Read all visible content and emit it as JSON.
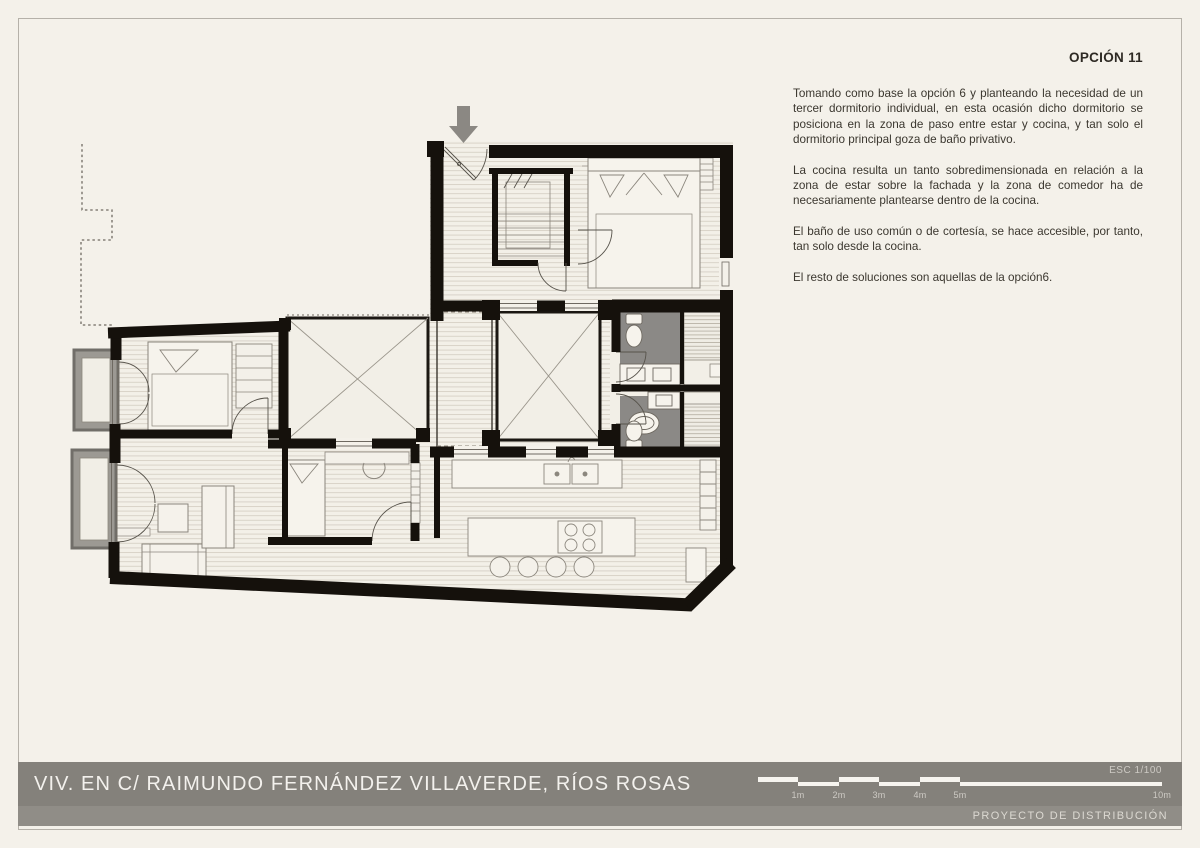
{
  "page": {
    "option_label": "OPCIÓN 11",
    "footer_label": "PROYECTO DE DISTRIBUCIÓN"
  },
  "notes": {
    "paragraphs": [
      "Tomando como base la opción 6 y planteando la necesidad de un tercer dormitorio individual, en esta ocasión dicho dormitorio se posiciona en la zona de paso entre estar y cocina, y tan solo el dormitorio principal goza de baño privativo.",
      "La cocina resulta un tanto sobredimensionada en relación a la zona de estar sobre la fachada y la zona de comedor ha de necesariamente plantearse dentro de la cocina.",
      "El baño de uso común o de cortesía, se hace accesible, por tanto, tan solo desde la cocina.",
      "El resto de soluciones son aquellas de la opción6."
    ]
  },
  "title_block": {
    "project_title": "VIV. EN C/ RAIMUNDO FERNÁNDEZ VILLAVERDE, RÍOS ROSAS",
    "scale_label": "ESC  1/100",
    "scale_bar": {
      "labels": [
        "1m",
        "2m",
        "3m",
        "4m",
        "5m",
        "10m"
      ]
    }
  },
  "plan": {
    "entry_arrow_icon": "arrow-down"
  },
  "colors": {
    "paper": "#f4f1ea",
    "frame": "#b5b1a9",
    "ink": "#3b372f",
    "band": "#84817b",
    "strip": "#908d87",
    "band_text": "#f3f1ed",
    "band_muted": "#cdcac4",
    "wall": "#15110c",
    "bath_gray": "#8b8986",
    "balcony_gray": "#9c9993",
    "arrow_gray": "#8b8883"
  }
}
